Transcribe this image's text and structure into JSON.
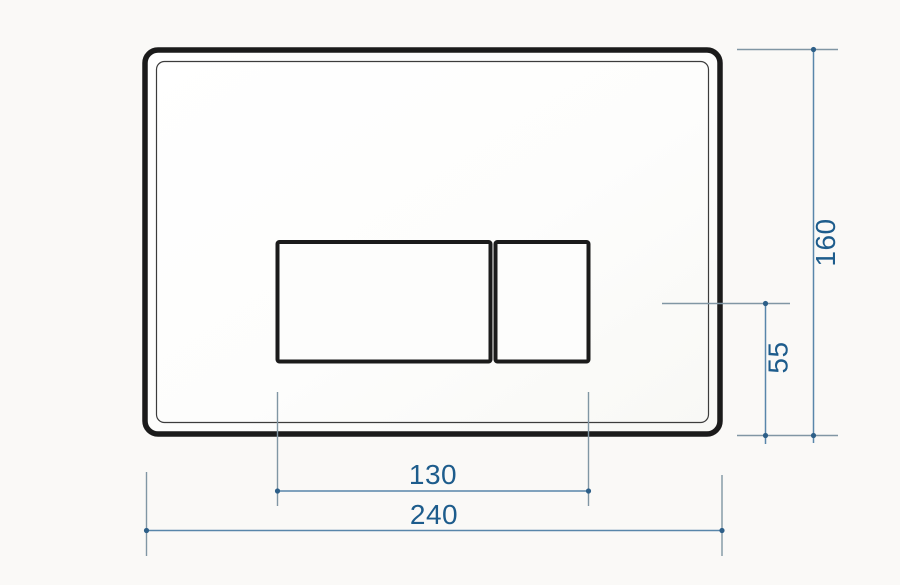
{
  "page": {
    "background_color": "#faf9f7",
    "description": "Technical dimensional drawing of a dual flush plate"
  },
  "drawing": {
    "plate": {
      "outline_color": "#1b1b1b",
      "fill_color": "#fdfdfc"
    },
    "style": {
      "dimension_line_color": "#5886aa",
      "extension_line_color": "#8096a4",
      "marker_color": "#2d5f88",
      "dimension_text_color": "#1d5c8c"
    },
    "dimensions": {
      "plate_width": "240",
      "plate_height": "160",
      "buttons_width": "130",
      "button_axis_to_bottom": "55"
    }
  }
}
